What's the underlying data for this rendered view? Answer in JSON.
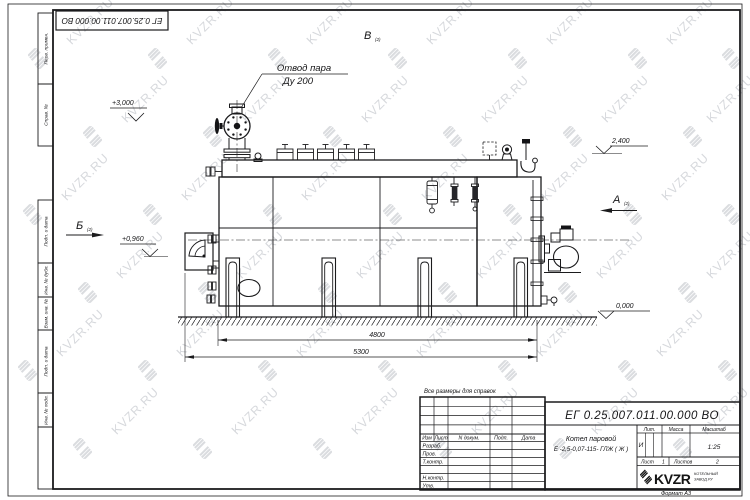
{
  "page": {
    "corner_stamp": "ЕГ 0.25.007.011.00.000  ВО",
    "format_label": "Формат А3",
    "note": "Все размеры для справок"
  },
  "margin_labels": [
    "Перв. примен.",
    "Справ. №",
    "Подп. и дата",
    "Инв. № дубл.",
    "Взам. инв. №",
    "Подп. и дата",
    "Инв. № подл."
  ],
  "drawing": {
    "leader_steam": {
      "line1": "Отвод пара",
      "line2": "Ду 200"
    },
    "elevations": {
      "top": "+3,000",
      "right": "2,400",
      "mid": "+0,960",
      "ground": "0,000"
    },
    "view_markers": {
      "b": "Б",
      "v": "В",
      "a": "А",
      "sheet_ref": "(2)"
    },
    "dimensions": {
      "inner": "4800",
      "outer": "5300"
    }
  },
  "title_block": {
    "designation": "ЕГ 0.25.007.011.00.000  ВО",
    "name_line1": "Котел паровой",
    "name_line2": "Е -2,5-0,07-115- ГЛЖ ( Ж )",
    "header": {
      "izm": "Изм",
      "list": "Лист",
      "doc": "N докум.",
      "podp": "Подп.",
      "data": "Дата"
    },
    "rows": [
      "Разраб.",
      "Пров.",
      "Т.контр.",
      "Н.контр.",
      "Утв."
    ],
    "lit_label": "Лит.",
    "mass_label": "Масса",
    "scale_label": "Масштаб",
    "lit_value": "И",
    "scale_value": "1:25",
    "sheet_label": "Лист",
    "sheet_value": "1",
    "sheets_label": "Листов",
    "sheets_value": "2",
    "logo_text": "KVZR",
    "logo_sub1": "КОТЕЛЬНЫЙ",
    "logo_sub2": "ЗАВОД.РУ"
  },
  "watermark": {
    "text": "KVZR.RU",
    "text_rows": [
      {
        "y": 14,
        "xs": [
          60,
          180,
          300,
          420,
          540,
          660
        ]
      },
      {
        "y": 92,
        "xs": [
          115,
          235,
          355,
          475,
          595,
          700
        ]
      },
      {
        "y": 170,
        "xs": [
          55,
          175,
          295,
          415,
          535,
          655
        ]
      },
      {
        "y": 248,
        "xs": [
          110,
          230,
          350,
          470,
          590,
          700
        ]
      },
      {
        "y": 326,
        "xs": [
          50,
          170,
          290,
          410,
          530,
          650
        ]
      },
      {
        "y": 404,
        "xs": [
          105,
          225,
          345,
          465,
          585,
          695
        ]
      }
    ],
    "icon_rows": [
      {
        "y": 48,
        "xs": [
          28,
          148,
          268,
          388,
          508,
          628,
          722
        ]
      },
      {
        "y": 126,
        "xs": [
          83,
          203,
          323,
          443,
          563,
          683
        ]
      },
      {
        "y": 204,
        "xs": [
          23,
          143,
          263,
          383,
          503,
          623,
          722
        ]
      },
      {
        "y": 282,
        "xs": [
          78,
          198,
          318,
          438,
          558,
          678
        ]
      },
      {
        "y": 360,
        "xs": [
          18,
          138,
          258,
          378,
          498,
          618,
          718
        ]
      },
      {
        "y": 438,
        "xs": [
          73,
          193,
          313,
          433,
          553,
          673
        ]
      }
    ]
  }
}
